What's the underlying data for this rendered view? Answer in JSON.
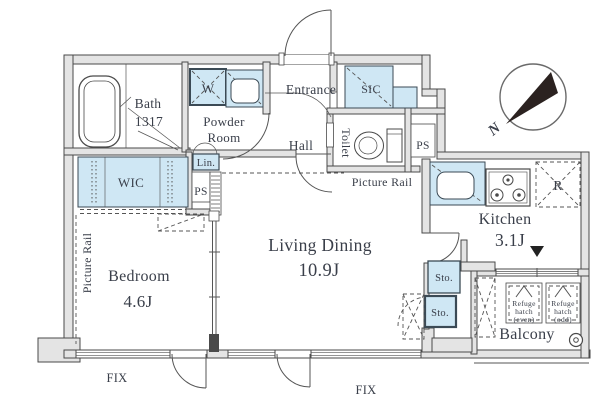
{
  "floorplan": {
    "rooms": {
      "bath": {
        "name": "Bath",
        "dimension": "1317"
      },
      "powder_room": {
        "name_line1": "Powder",
        "name_line2": "Room"
      },
      "entrance": {
        "name": "Entrance"
      },
      "shoe_closet": {
        "name": "SIC"
      },
      "hall": {
        "name": "Hall"
      },
      "toilet": {
        "name": "Toilet"
      },
      "walk_in_closet": {
        "name": "WIC"
      },
      "bedroom": {
        "name": "Bedroom",
        "size": "4.6J"
      },
      "living_dining": {
        "name": "Living Dining",
        "size": "10.9J"
      },
      "kitchen": {
        "name": "Kitchen",
        "size": "3.1J"
      },
      "balcony": {
        "name": "Balcony"
      }
    },
    "fixtures": {
      "washer": "W",
      "linen": "Lin.",
      "pipe_space_left": "PS",
      "pipe_space_right": "PS",
      "refrigerator": "R",
      "storage_upper": "Sto.",
      "storage_lower": "Sto."
    },
    "annotations": {
      "picture_rail_living": "Picture Rail",
      "picture_rail_bedroom": "Picture Rail",
      "fix_window_left": "FIX",
      "fix_window_right": "FIX",
      "compass_north": "N",
      "refuge_hatch_even": {
        "line1": "Refuge",
        "line2": "hatch",
        "line3": "(even)"
      },
      "refuge_hatch_odd": {
        "line1": "Refuge",
        "line2": "hatch",
        "line3": "(odd)"
      }
    },
    "colors": {
      "fixture_fill": "#cfe7f4",
      "wall_fill": "#e4e4e4",
      "wall_stroke": "#4a4a4a",
      "label_color": "#3a3f4a",
      "needle_color": "#2b2220"
    }
  }
}
